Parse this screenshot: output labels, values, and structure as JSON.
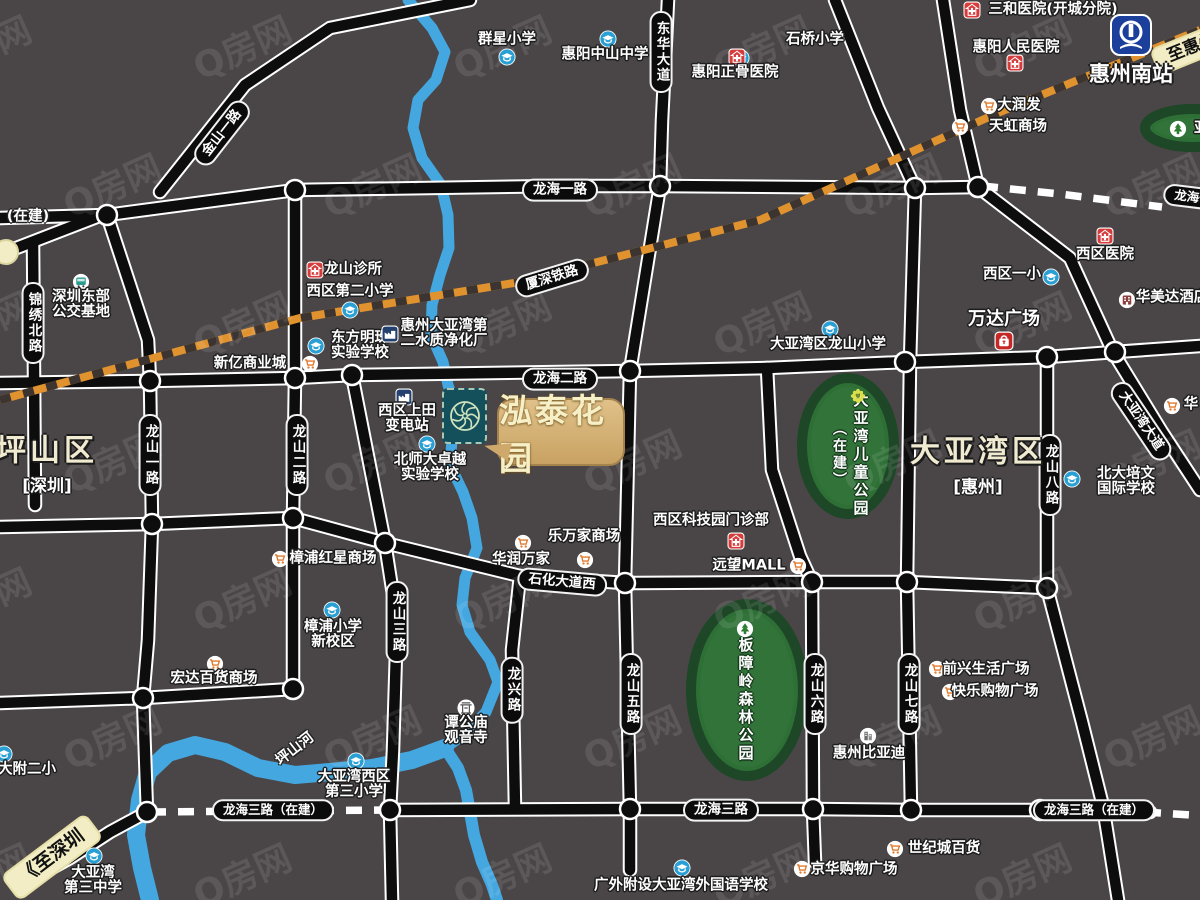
{
  "watermark": {
    "text": "Q房网"
  },
  "colors": {
    "bg": "#4a4647",
    "road": "#0d0d0d",
    "road_edge": "#ffffff",
    "rail_orange": "#e0922f",
    "rail_dark": "#3c3430",
    "water": "#45a7e0",
    "park_fill": "#2e6f36",
    "park_edge": "#1d4726",
    "pill_bg": "#0b0b0b",
    "bubble_gold": "#d4b176",
    "cream": "#f2edc4",
    "marker_teal": "#14505c"
  },
  "project": {
    "name": "泓泰花园"
  },
  "station": {
    "name": "惠州南站"
  },
  "regions": [
    {
      "name": "坪山区",
      "sub": "[深圳]",
      "x": 47,
      "y": 441
    },
    {
      "name": "大亚湾区",
      "sub": "[惠州]",
      "x": 978,
      "y": 442
    }
  ],
  "road_pills": [
    {
      "t": "龙海一路",
      "x": 560,
      "y": 190
    },
    {
      "t": "龙海二路",
      "x": 560,
      "y": 379
    },
    {
      "t": "石化大道西",
      "x": 562,
      "y": 582,
      "rot": 5
    },
    {
      "t": "龙海三路",
      "x": 721,
      "y": 810
    },
    {
      "t": "龙海三路（在建）",
      "x": 273,
      "y": 810,
      "fs": 12.5
    },
    {
      "t": "龙海三路（在建）",
      "x": 1094,
      "y": 810,
      "fs": 12.5
    },
    {
      "t": "厦深铁路",
      "x": 552,
      "y": 278,
      "rot": -17
    },
    {
      "t": "大亚湾大道",
      "x": 1141,
      "y": 421,
      "rot": 56
    },
    {
      "t": "金山一路",
      "x": 222,
      "y": 133,
      "rot": -52
    },
    {
      "t": "龙海一路（在建）",
      "x": 1224,
      "y": 201,
      "rot": 7,
      "fs": 12.5
    },
    {
      "t": "东华大道",
      "x": 661,
      "y": 52,
      "v": true
    },
    {
      "t": "锦绣北路",
      "x": 33,
      "y": 323,
      "v": true
    },
    {
      "t": "龙山一路",
      "x": 150,
      "y": 455,
      "v": true
    },
    {
      "t": "龙山二路",
      "x": 297,
      "y": 455,
      "v": true
    },
    {
      "t": "龙山三路",
      "x": 397,
      "y": 622,
      "v": true
    },
    {
      "t": "龙兴路",
      "x": 512,
      "y": 690,
      "v": true
    },
    {
      "t": "龙山五路",
      "x": 631,
      "y": 694,
      "v": true
    },
    {
      "t": "龙山六路",
      "x": 815,
      "y": 694,
      "v": true
    },
    {
      "t": "龙山七路",
      "x": 909,
      "y": 694,
      "v": true
    },
    {
      "t": "龙山八路",
      "x": 1050,
      "y": 475,
      "v": true
    },
    {
      "t": "《至深圳",
      "x": 52,
      "y": 857,
      "rot": -37,
      "style": "yellow",
      "fs": 19
    },
    {
      "t": "至惠州",
      "x": 1192,
      "y": 48,
      "rot": -22,
      "style": "yellow",
      "fs": 17
    }
  ],
  "free_labels": [
    {
      "t": "(在建)",
      "x": 28,
      "y": 215
    },
    {
      "t": "坪山河",
      "x": 294,
      "y": 748,
      "rot": -38
    }
  ],
  "pois": [
    {
      "icon": "school-icon",
      "ix": 507,
      "iy": 57,
      "lines": [
        "群星小学"
      ],
      "tx": 507,
      "ty": 40
    },
    {
      "icon": "school-icon",
      "ix": 608,
      "iy": 39,
      "lines": [
        "惠阳中山中学"
      ],
      "tx": 605,
      "ty": 55
    },
    {
      "icon": "school-icon",
      "ix": 741,
      "iy": 58,
      "lines": [
        "石桥小学"
      ],
      "tx": 815,
      "ty": 40
    },
    {
      "icon": "school-icon",
      "ix": 350,
      "iy": 310,
      "lines": [
        "西区第二小学"
      ],
      "tx": 350,
      "ty": 292
    },
    {
      "icon": "school-icon",
      "ix": 316,
      "iy": 346,
      "lines": [
        "东方明珠",
        "实验学校"
      ],
      "tx": 360,
      "ty": 346
    },
    {
      "icon": "school-icon",
      "ix": 427,
      "iy": 444,
      "lines": [
        "北师大卓越",
        "实验学校"
      ],
      "tx": 430,
      "ty": 468
    },
    {
      "icon": "school-icon",
      "ix": 830,
      "iy": 329,
      "lines": [
        "大亚湾区龙山小学"
      ],
      "tx": 828,
      "ty": 345
    },
    {
      "icon": "school-icon",
      "ix": 1051,
      "iy": 277,
      "lines": [
        "西区一小"
      ],
      "tx": 1012,
      "ty": 275
    },
    {
      "icon": "school-icon",
      "ix": 332,
      "iy": 610,
      "lines": [
        "樟浦小学",
        "新校区"
      ],
      "tx": 333,
      "ty": 635
    },
    {
      "icon": "school-icon",
      "ix": 356,
      "iy": 761,
      "lines": [
        "大亚湾西区",
        "第三小学"
      ],
      "tx": 354,
      "ty": 785
    },
    {
      "icon": "school-icon",
      "ix": 94,
      "iy": 856,
      "lines": [
        "大亚湾",
        "第三中学"
      ],
      "tx": 93,
      "ty": 881
    },
    {
      "icon": "school-icon",
      "ix": 4,
      "iy": 754,
      "lines": [
        "大附二小"
      ],
      "tx": 27,
      "ty": 770
    },
    {
      "icon": "school-icon",
      "ix": 682,
      "iy": 868,
      "lines": [
        "广外附设大亚湾外国语学校"
      ],
      "tx": 681,
      "ty": 886
    },
    {
      "icon": "school-icon",
      "ix": 1072,
      "iy": 479,
      "lines": [
        "北大培文",
        "国际学校"
      ],
      "tx": 1126,
      "ty": 482
    },
    {
      "icon": "hospital-icon",
      "ix": 972,
      "iy": 10,
      "lines": [
        "三和医院(开城分院)"
      ],
      "tx": 1053,
      "ty": 10
    },
    {
      "icon": "hospital-icon",
      "ix": 1015,
      "iy": 63,
      "lines": [
        "惠阳人民医院"
      ],
      "tx": 1016,
      "ty": 48
    },
    {
      "icon": "hospital-icon",
      "ix": 737,
      "iy": 57,
      "lines": [
        "惠阳正骨医院"
      ],
      "tx": 735,
      "ty": 73
    },
    {
      "icon": "hospital-icon",
      "ix": 315,
      "iy": 270,
      "lines": [
        "龙山诊所"
      ],
      "tx": 353,
      "ty": 270
    },
    {
      "icon": "hospital-icon",
      "ix": 1105,
      "iy": 236,
      "lines": [
        "西区医院"
      ],
      "tx": 1105,
      "ty": 255
    },
    {
      "icon": "hospital-icon",
      "ix": 736,
      "iy": 541,
      "lines": [
        "西区科技园门诊部"
      ],
      "tx": 711,
      "ty": 521
    },
    {
      "icon": "cart-icon",
      "ix": 989,
      "iy": 106,
      "lines": [
        "大润发"
      ],
      "tx": 1019,
      "ty": 106
    },
    {
      "icon": "cart-icon",
      "ix": 960,
      "iy": 127,
      "lines": [
        "天虹商场"
      ],
      "tx": 1018,
      "ty": 127
    },
    {
      "icon": "cart-icon",
      "ix": 310,
      "iy": 364,
      "lines": [
        "新亿商业城"
      ],
      "tx": 250,
      "ty": 364
    },
    {
      "icon": "cart-icon",
      "ix": 280,
      "iy": 559,
      "lines": [
        "樟浦红星商场"
      ],
      "tx": 333,
      "ty": 559
    },
    {
      "icon": "cart-icon",
      "ix": 215,
      "iy": 664,
      "lines": [
        "宏达百货商场"
      ],
      "tx": 214,
      "ty": 679
    },
    {
      "icon": "cart-icon",
      "ix": 523,
      "iy": 543,
      "lines": [
        "乐万家商场"
      ],
      "tx": 584,
      "ty": 537
    },
    {
      "icon": "cart-icon",
      "ix": 585,
      "iy": 560,
      "lines": [
        "华润万家"
      ],
      "tx": 521,
      "ty": 560
    },
    {
      "icon": "cart-icon",
      "ix": 798,
      "iy": 566,
      "lines": [
        "远望MALL"
      ],
      "tx": 749,
      "ty": 566
    },
    {
      "icon": "cart-icon",
      "ix": 937,
      "iy": 669,
      "lines": [
        "前兴生活广场"
      ],
      "tx": 986,
      "ty": 670
    },
    {
      "icon": "cart-icon",
      "ix": 950,
      "iy": 692,
      "lines": [
        "快乐购物广场"
      ],
      "tx": 995,
      "ty": 692
    },
    {
      "icon": "cart-icon",
      "ix": 895,
      "iy": 849,
      "lines": [
        "世纪城百货"
      ],
      "tx": 944,
      "ty": 849
    },
    {
      "icon": "cart-icon",
      "ix": 802,
      "iy": 869,
      "lines": [
        "京华购物广场"
      ],
      "tx": 854,
      "ty": 870
    },
    {
      "icon": "cart-icon",
      "ix": 1172,
      "iy": 406,
      "lines": [
        "华"
      ],
      "tx": 1191,
      "ty": 405
    },
    {
      "icon": "bus-icon",
      "ix": 81,
      "iy": 282,
      "lines": [
        "深圳东部",
        "公交基地"
      ],
      "tx": 81,
      "ty": 305
    },
    {
      "icon": "factory-icon",
      "ix": 390,
      "iy": 334,
      "lines": [
        "惠州大亚湾第",
        "二水质净化厂"
      ],
      "tx": 444,
      "ty": 334
    },
    {
      "icon": "factory-icon",
      "ix": 404,
      "iy": 397,
      "lines": [
        "西区上田",
        "变电站"
      ],
      "tx": 407,
      "ty": 419
    },
    {
      "icon": "temple-icon",
      "ix": 466,
      "iy": 708,
      "lines": [
        "谭公庙",
        "观音寺"
      ],
      "tx": 466,
      "ty": 731
    },
    {
      "icon": "building-icon",
      "ix": 868,
      "iy": 736,
      "lines": [
        "惠州比亚迪"
      ],
      "tx": 869,
      "ty": 754
    },
    {
      "icon": "hotel-icon",
      "ix": 1127,
      "iy": 300,
      "lines": [
        "华美达酒店"
      ],
      "tx": 1172,
      "ty": 298
    },
    {
      "icon": "mall-icon",
      "ix": 1004,
      "iy": 341,
      "lines": [
        "万达广场"
      ],
      "tx": 1004,
      "ty": 320,
      "fs": 18
    }
  ],
  "parks": [
    {
      "name": "大亚湾儿童公园",
      "extra": "（在建）",
      "cx": 848,
      "cy": 446,
      "rx": 46,
      "ry": 68,
      "icon": "flower-icon",
      "icx": 858,
      "icy": 396,
      "tx": 861,
      "ty": 455,
      "ex": 839,
      "ey": 455
    },
    {
      "name": "板障岭森林公园",
      "cx": 747,
      "cy": 690,
      "rx": 56,
      "ry": 86,
      "icon": "tree-icon",
      "icx": 745,
      "icy": 629,
      "tx": 746,
      "ty": 700
    },
    {
      "name": "亚",
      "cx": 1192,
      "cy": 128,
      "rx": 47,
      "ry": 19,
      "icon": "tree-icon",
      "icx": 1178,
      "icy": 129,
      "tx": 1194,
      "ty": 129,
      "horiz": true
    }
  ],
  "geometry": {
    "roads": [
      [
        [
          0,
          218
        ],
        [
          107,
          215
        ],
        [
          295,
          190
        ],
        [
          560,
          186
        ],
        [
          660,
          186
        ],
        [
          915,
          188
        ],
        [
          978,
          187
        ]
      ],
      [
        [
          0,
          383
        ],
        [
          150,
          381
        ],
        [
          295,
          378
        ],
        [
          352,
          375
        ],
        [
          630,
          371
        ],
        [
          767,
          368
        ],
        [
          905,
          362
        ],
        [
          1047,
          357
        ],
        [
          1115,
          352
        ],
        [
          1200,
          346
        ]
      ],
      [
        [
          0,
          527
        ],
        [
          152,
          524
        ],
        [
          293,
          518
        ],
        [
          385,
          543
        ],
        [
          520,
          576
        ],
        [
          625,
          583
        ],
        [
          812,
          582
        ],
        [
          907,
          582
        ],
        [
          1047,
          588
        ]
      ],
      [
        [
          390,
          810
        ],
        [
          630,
          809
        ],
        [
          813,
          809
        ],
        [
          911,
          810
        ],
        [
          1040,
          810
        ],
        [
          1150,
          812
        ]
      ],
      [
        [
          147,
          812
        ],
        [
          110,
          832
        ],
        [
          70,
          858
        ],
        [
          30,
          880
        ]
      ],
      [
        [
          0,
          703
        ],
        [
          143,
          698
        ],
        [
          293,
          689
        ]
      ],
      [
        [
          33,
          242
        ],
        [
          35,
          505
        ]
      ],
      [
        [
          107,
          215
        ],
        [
          130,
          285
        ],
        [
          148,
          340
        ],
        [
          150,
          381
        ],
        [
          152,
          524
        ],
        [
          148,
          640
        ],
        [
          143,
          698
        ],
        [
          147,
          812
        ]
      ],
      [
        [
          295,
          190
        ],
        [
          295,
          378
        ],
        [
          293,
          518
        ],
        [
          293,
          689
        ]
      ],
      [
        [
          352,
          375
        ],
        [
          385,
          543
        ],
        [
          397,
          620
        ],
        [
          393,
          750
        ],
        [
          390,
          810
        ],
        [
          392,
          900
        ]
      ],
      [
        [
          520,
          576
        ],
        [
          512,
          650
        ],
        [
          515,
          808
        ]
      ],
      [
        [
          668,
          0
        ],
        [
          662,
          120
        ],
        [
          660,
          186
        ],
        [
          630,
          371
        ],
        [
          625,
          583
        ],
        [
          630,
          809
        ],
        [
          630,
          870
        ]
      ],
      [
        [
          767,
          368
        ],
        [
          772,
          470
        ],
        [
          800,
          556
        ],
        [
          812,
          582
        ],
        [
          813,
          809
        ],
        [
          815,
          862
        ]
      ],
      [
        [
          835,
          0
        ],
        [
          878,
          108
        ],
        [
          915,
          188
        ],
        [
          910,
          362
        ],
        [
          907,
          582
        ],
        [
          911,
          810
        ]
      ],
      [
        [
          943,
          0
        ],
        [
          960,
          110
        ],
        [
          978,
          187
        ]
      ],
      [
        [
          978,
          187
        ],
        [
          1070,
          258
        ],
        [
          1113,
          352
        ],
        [
          1162,
          432
        ],
        [
          1200,
          490
        ]
      ],
      [
        [
          1047,
          357
        ],
        [
          1047,
          588
        ],
        [
          1082,
          722
        ],
        [
          1103,
          806
        ],
        [
          1118,
          900
        ]
      ],
      [
        [
          160,
          192
        ],
        [
          245,
          85
        ],
        [
          330,
          28
        ],
        [
          470,
          0
        ]
      ],
      [
        [
          6,
          252
        ],
        [
          107,
          213
        ]
      ]
    ],
    "dashed_roads": [
      [
        [
          982,
          186
        ],
        [
          1060,
          194
        ],
        [
          1162,
          207
        ]
      ],
      [
        [
          150,
          812
        ],
        [
          390,
          810
        ]
      ],
      [
        [
          1145,
          812
        ],
        [
          1205,
          816
        ]
      ]
    ],
    "railway": [
      [
        0,
        400
      ],
      [
        300,
        318
      ],
      [
        520,
        282
      ],
      [
        760,
        220
      ],
      [
        1000,
        112
      ],
      [
        1200,
        30
      ]
    ],
    "rivers": [
      {
        "w": 11,
        "pts": [
          [
            408,
            0
          ],
          [
            432,
            28
          ],
          [
            445,
            52
          ],
          [
            436,
            80
          ],
          [
            418,
            100
          ],
          [
            413,
            128
          ],
          [
            422,
            158
          ],
          [
            441,
            185
          ],
          [
            448,
            215
          ],
          [
            449,
            248
          ],
          [
            440,
            275
          ],
          [
            432,
            305
          ],
          [
            431,
            335
          ],
          [
            443,
            362
          ],
          [
            448,
            385
          ],
          [
            457,
            412
          ],
          [
            452,
            440
          ],
          [
            450,
            465
          ],
          [
            463,
            492
          ],
          [
            472,
            518
          ],
          [
            477,
            548
          ],
          [
            465,
            578
          ],
          [
            462,
            605
          ],
          [
            470,
            632
          ],
          [
            490,
            660
          ],
          [
            498,
            682
          ],
          [
            486,
            712
          ],
          [
            466,
            733
          ],
          [
            445,
            748
          ]
        ]
      },
      {
        "w": 18,
        "pts": [
          [
            445,
            748
          ],
          [
            412,
            760
          ],
          [
            372,
            768
          ],
          [
            330,
            772
          ],
          [
            295,
            775
          ],
          [
            258,
            768
          ],
          [
            225,
            752
          ],
          [
            195,
            745
          ],
          [
            168,
            753
          ],
          [
            148,
            772
          ],
          [
            140,
            800
          ],
          [
            136,
            835
          ],
          [
            142,
            868
          ],
          [
            150,
            900
          ]
        ]
      },
      {
        "w": 12,
        "pts": [
          [
            445,
            748
          ],
          [
            458,
            768
          ],
          [
            466,
            790
          ],
          [
            470,
            812
          ],
          [
            474,
            835
          ],
          [
            482,
            862
          ],
          [
            492,
            885
          ],
          [
            497,
            900
          ]
        ]
      }
    ],
    "junctions": [
      [
        107,
        215
      ],
      [
        295,
        190
      ],
      [
        660,
        186
      ],
      [
        915,
        188
      ],
      [
        978,
        187
      ],
      [
        150,
        381
      ],
      [
        295,
        378
      ],
      [
        352,
        375
      ],
      [
        630,
        371
      ],
      [
        905,
        362
      ],
      [
        1047,
        357
      ],
      [
        1115,
        352
      ],
      [
        152,
        524
      ],
      [
        293,
        518
      ],
      [
        385,
        543
      ],
      [
        625,
        583
      ],
      [
        812,
        582
      ],
      [
        907,
        582
      ],
      [
        1047,
        588
      ],
      [
        147,
        812
      ],
      [
        390,
        810
      ],
      [
        630,
        809
      ],
      [
        813,
        809
      ],
      [
        911,
        810
      ],
      [
        1040,
        810
      ],
      [
        143,
        698
      ],
      [
        293,
        689
      ]
    ],
    "terminus": [
      6,
      252
    ]
  }
}
